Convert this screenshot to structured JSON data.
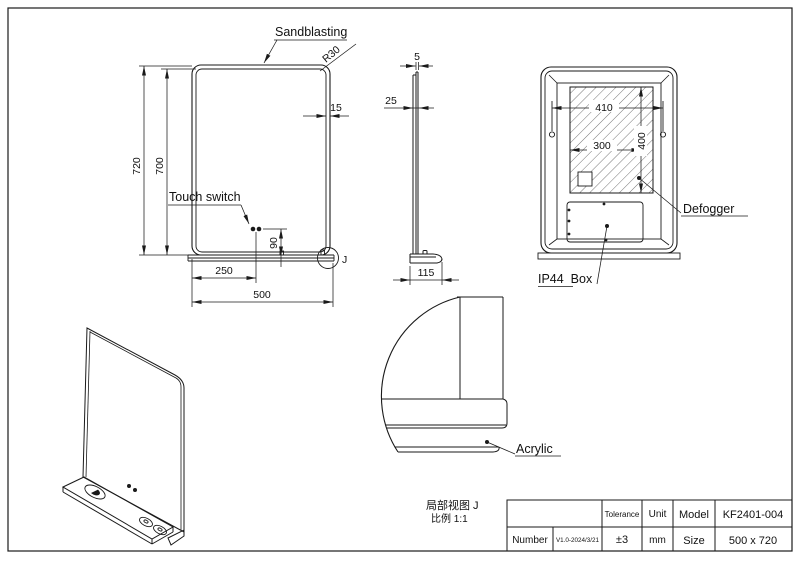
{
  "front_view": {
    "sandblasting_label": "Sandblasting",
    "corner_radius": "R30",
    "sandblast_border_width": "15",
    "outer_height": "720",
    "inner_height": "700",
    "touch_switch_label": "Touch switch",
    "switch_height_from_shelf": "90",
    "switch_offset_from_left": "250",
    "overall_width": "500",
    "detail_mark": "J"
  },
  "side_view": {
    "glass_thickness": "5",
    "frame_depth": "25",
    "shelf_depth": "115"
  },
  "back_view": {
    "defogger_width": "410",
    "defogger_height": "400",
    "inner_width": "300",
    "defogger_label": "Defogger",
    "junction_box_label": "IP44  Box"
  },
  "detail_view": {
    "material_label": "Acrylic",
    "caption": "局部视图 J",
    "scale_note": "比例 1:1"
  },
  "title_block": {
    "tolerance_label": "Tolerance",
    "tolerance_value": "±3",
    "unit_label": "Unit",
    "unit_value": "mm",
    "model_label": "Model",
    "model_value": "KF2401-004",
    "number_label": "Number",
    "number_value": "V1.0-2024/3/21",
    "size_label": "Size",
    "size_value": "500 x 720"
  },
  "colors": {
    "line": "#1a1a1a",
    "background": "#ffffff"
  }
}
